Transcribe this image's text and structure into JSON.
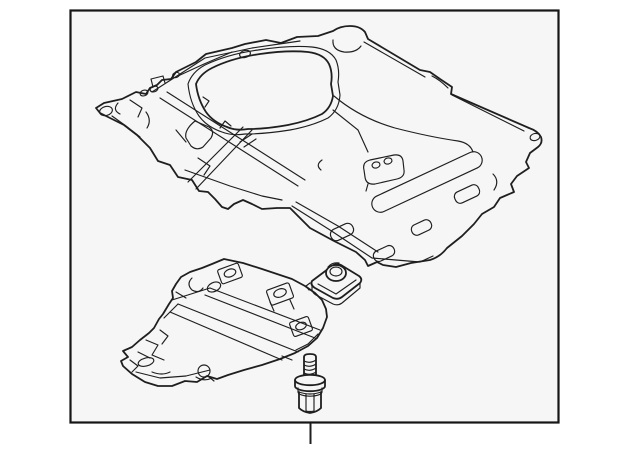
{
  "colors": {
    "page_bg": "#ffffff",
    "frame_fill": "#f6f6f6",
    "frame_border": "#161616",
    "line": "#1f1f1f"
  },
  "diagram": {
    "kind": "auto-parts line illustration",
    "parts": [
      {
        "name": "engine-under-cover",
        "description": "large main splash shield panel, drawn in perspective, upper area"
      },
      {
        "name": "side-deflector-panel",
        "description": "smaller jagged side under-cover, lower left"
      },
      {
        "name": "u-nut-clip",
        "description": "folded sheet-metal retainer clip with round boss, center"
      },
      {
        "name": "flange-bolt",
        "description": "threaded stud with washer flange and hex head, bottom center"
      }
    ],
    "callout": {
      "shape": "vertical tick below frame",
      "position": "bottom-center"
    }
  }
}
